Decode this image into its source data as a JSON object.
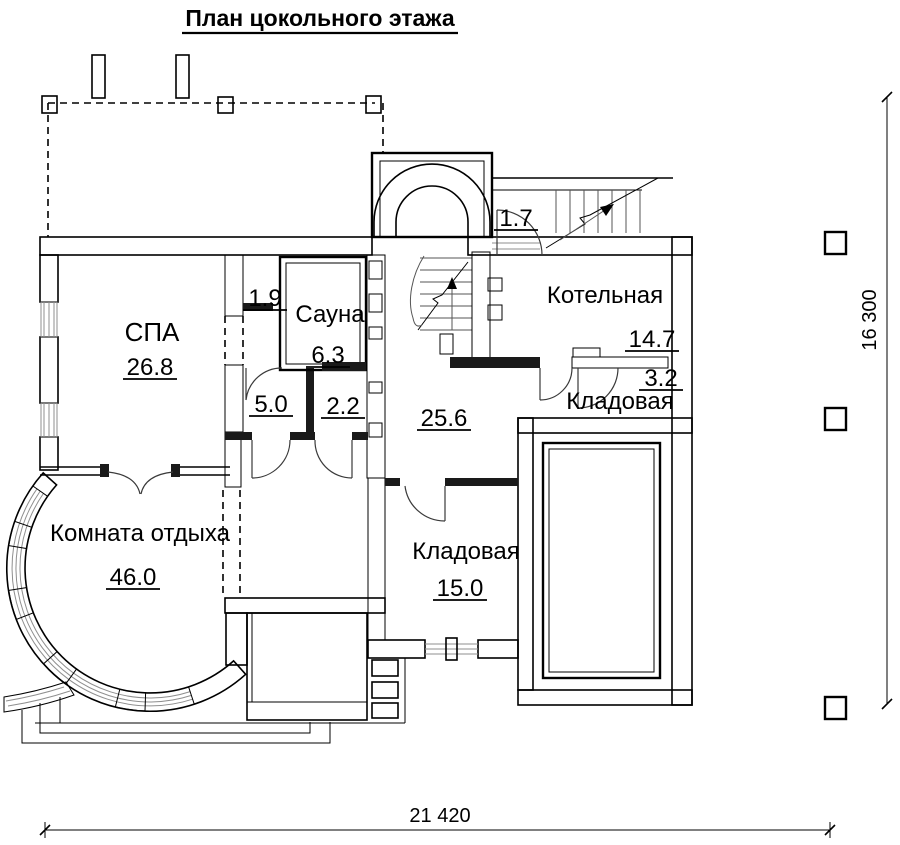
{
  "title": "План цокольного этажа",
  "rooms": {
    "spa": {
      "name": "СПА",
      "area": "26.8"
    },
    "sauna": {
      "name": "Сауна",
      "area": "6.3"
    },
    "closet": {
      "area": "1.9"
    },
    "shower": {
      "area": "5.0"
    },
    "wc": {
      "area": "2.2"
    },
    "hall": {
      "area": "25.6"
    },
    "boiler": {
      "name": "Котельная",
      "area": "14.7"
    },
    "pantry_small": {
      "name": "Кладовая",
      "area": "3.2"
    },
    "pantry": {
      "name": "Кладовая",
      "area": "15.0"
    },
    "lounge": {
      "name": "Комната отдыха",
      "area": "46.0"
    },
    "entry": {
      "area": "1.7"
    }
  },
  "dimensions": {
    "overall_width": "21 420",
    "overall_height": "16 300"
  },
  "colors": {
    "line": "#000000",
    "wall_fill": "#ededed",
    "hatch_fill": "#e2e2e2",
    "solid_wall": "#1a1a1a"
  }
}
